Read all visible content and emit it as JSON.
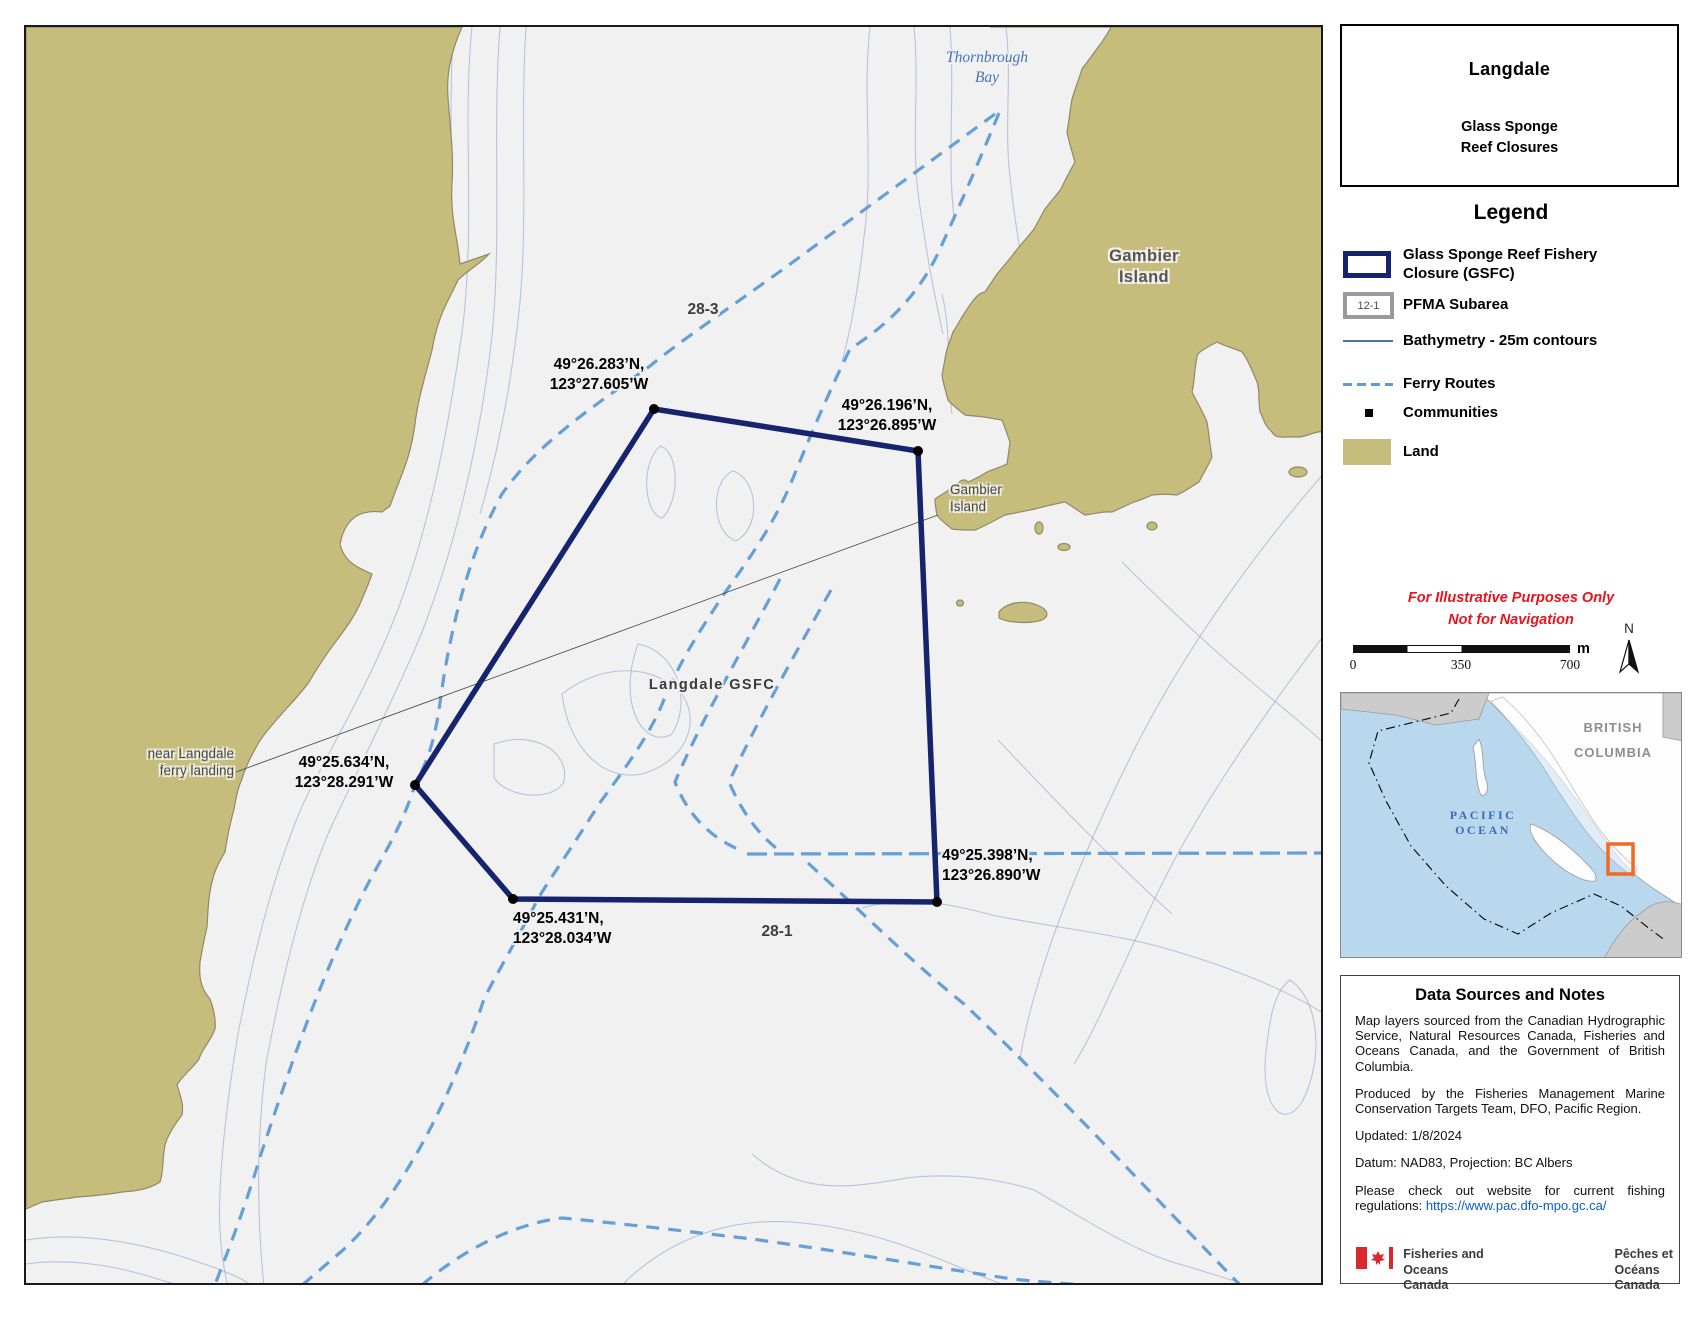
{
  "map": {
    "place_labels": {
      "thornbrough_bay_line1": "Thornbrough",
      "thornbrough_bay_line2": "Bay",
      "gambier_island_large_line1": "Gambier",
      "gambier_island_large_line2": "Island",
      "gambier_island_small_line1": "Gambier",
      "gambier_island_small_line2": "Island",
      "near_ferry_landing_line1": "near Langdale",
      "near_ferry_landing_line2": "ferry landing",
      "closure_name": "Langdale GSFC",
      "pfma_subarea_28_3": "28-3",
      "pfma_subarea_28_1": "28-1"
    },
    "closure_vertex_labels": {
      "nw_line1": "49°26.283’N,",
      "nw_line2": "123°27.605’W",
      "ne_line1": "49°26.196’N,",
      "ne_line2": "123°26.895’W",
      "west_line1": "49°25.634’N,",
      "west_line2": "123°28.291’W",
      "sw_line1": "49°25.431’N,",
      "sw_line2": "123°28.034’W",
      "se_line1": "49°25.398’N,",
      "se_line2": "123°26.890’W"
    }
  },
  "panel": {
    "title": "Langdale",
    "subtitle_line1": "Glass Sponge",
    "subtitle_line2": "Reef Closures",
    "legend": {
      "heading": "Legend",
      "gsfc_label_line1": "Glass Sponge Reef Fishery",
      "gsfc_label_line2": "Closure (GSFC)",
      "pfma_swatch_text": "12-1",
      "pfma_label": "PFMA Subarea",
      "bathymetry_label": "Bathymetry - 25m contours",
      "ferry_label": "Ferry Routes",
      "communities_label": "Communities",
      "land_label": "Land"
    },
    "disclaimer_line1": "For Illustrative Purposes Only",
    "disclaimer_line2": "Not for Navigation",
    "scale_bar": {
      "tick_start": "0",
      "tick_mid": "350",
      "tick_end": "700",
      "unit": "m"
    },
    "north_arrow_label": "N",
    "inset": {
      "region_line1": "BRITISH",
      "region_line2": "COLUMBIA",
      "ocean_line1": "PACIFIC",
      "ocean_line2": "OCEAN"
    },
    "notes": {
      "heading": "Data Sources and Notes",
      "paragraph1": "Map layers sourced from the Canadian Hydrographic Service, Natural Resources Canada, Fisheries and Oceans Canada, and the Government of British Columbia.",
      "paragraph2": "Produced by the Fisheries Management Marine Conservation Targets Team, DFO, Pacific Region.",
      "updated": "Updated: 1/8/2024",
      "datum": "Datum: NAD83, Projection: BC Albers",
      "regulations_text": "Please check out website for current fishing regulations: ",
      "regulations_link": "https://www.pac.dfo-mpo.gc.ca/",
      "wordmark_en_line1": "Fisheries and Oceans",
      "wordmark_en_line2": "Canada",
      "wordmark_fr_line1": "Pêches et Océans",
      "wordmark_fr_line2": "Canada"
    }
  },
  "colors": {
    "closure_outline": "#16246d",
    "land": "#c6bd7c",
    "water": "#f1f1f2",
    "ferry_route": "#5e9ad3",
    "bathymetry": "#96a5cb",
    "disclaimer_red": "#e8131c",
    "link_blue": "#0b5bd3",
    "inset_highlight_orange": "#f26a22",
    "inset_water": "#b9d7ed"
  }
}
